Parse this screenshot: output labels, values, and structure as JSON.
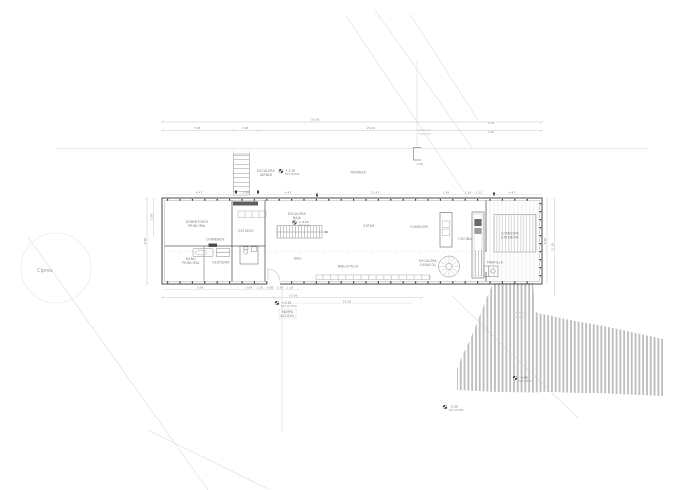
{
  "site": {
    "tree_label": "Cipres",
    "note_1": "LINEA DE",
    "note_2": "TERRENO"
  },
  "rooms": {
    "dormitorio_1": "DORMITORIO",
    "dormitorio_2": "PRINCIPAL",
    "chimenea": "CHIMENEA",
    "estudio": "ESTUDIO",
    "bano_1": "BAÑO",
    "bano_2": "PRINCIPAL",
    "vestidor": "VESTIDOR",
    "hall": "HALL",
    "estar": "ESTAR",
    "comedor": "COMEDOR",
    "cocina": "COCINA",
    "biblioteca": "BIBLIOTECA",
    "caracol_1": "ESCALERA",
    "caracol_2": "CARACOL",
    "parrilla": "PARRILLA",
    "comedor_ext_1": "COMEDOR",
    "comedor_ext_2": "EXTERIOR",
    "escalera_1": "ESCALERA",
    "escalera_2": "BAJA",
    "esc_jardin_1": "ESCALERA",
    "esc_jardin_2": "JARDIN",
    "terraza": "TERRAZA",
    "rampa_1": "RAMPA",
    "rampa_2": "ACCESO",
    "deck_1": "DECK DE",
    "deck_2": "MADERA"
  },
  "levels": {
    "jardin_alto": {
      "value": "+ 2.30",
      "ref": "NPT JARDIN"
    },
    "interior": {
      "value": "+ 0.15",
      "ref": "NPT PISO"
    },
    "acceso": {
      "value": "+ 0.15",
      "ref": "NPT ACCESO"
    },
    "deck": {
      "value": "- 0.90",
      "ref": "NPT DECK"
    },
    "jardin_bajo": {
      "value": "- 2.30",
      "ref": "NPT JARDIN"
    }
  },
  "dimensions": {
    "total": "36.58",
    "seg_a": "7.98",
    "seg_b": "1.98",
    "seg_c": "26.62",
    "t1": "4.47",
    "t2": "0.98",
    "t3": "4.47",
    "t4": "10.47",
    "t5": "1.98",
    "t6": "1.38",
    "t7": "1.15",
    "t8": "4.47",
    "l1": "8.98",
    "l2": "2.98",
    "r1": "8.98",
    "r2": "11.38",
    "b1": "3.98",
    "b2": "0.98",
    "b3": "2.30",
    "b4": "0.88",
    "b5": "1.98",
    "b6": "1.38",
    "b_total": "10.98",
    "b_long": "16.98",
    "tr1": "0.15",
    "tr2": "0.30",
    "br1": "0.30"
  },
  "colors": {
    "wall": "#4a4a4a",
    "deck_slat": "#bfbfbf",
    "site_line": "#dcdcdc",
    "dim_line": "#b5b5b5"
  }
}
